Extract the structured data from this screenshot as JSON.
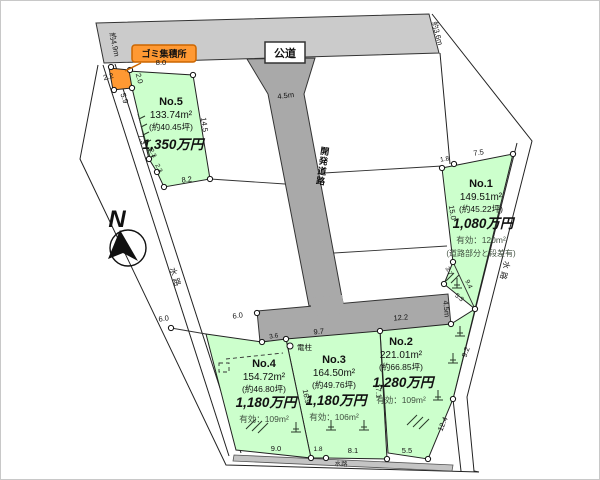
{
  "compass": {
    "north_label": "N"
  },
  "roads": {
    "public_road_label": "公道",
    "public_road_width": "約4.9m",
    "public_road_end_width": "約3.6m",
    "dev_road_label": "開発道路",
    "dev_road_width_top": "4.5m",
    "dev_road_width_bottom": "4.5m"
  },
  "features": {
    "garbage_station": "ゴミ集積所",
    "utility_pole": "電柱",
    "waterway_left": "水路",
    "waterway_right": "水路",
    "waterway_bottom": "水路"
  },
  "plots": [
    {
      "no": "No.1",
      "area": "149.51m²",
      "tsubo": "(約45.22坪)",
      "price": "1,080万円",
      "note1": "有効：120m²",
      "note2": "(道路部分と段差有)"
    },
    {
      "no": "No.2",
      "area": "221.01m²",
      "tsubo": "(約66.85坪)",
      "price": "1,280万円",
      "note1": "有効：109m²"
    },
    {
      "no": "No.3",
      "area": "164.50m²",
      "tsubo": "(約49.76坪)",
      "price": "1,180万円",
      "note1": "有効：106m²"
    },
    {
      "no": "No.4",
      "area": "154.72m²",
      "tsubo": "(約46.80坪)",
      "price": "1,180万円",
      "note1": "有効：109m²"
    },
    {
      "no": "No.5",
      "area": "133.74m²",
      "tsubo": "(約40.45坪)",
      "price": "1,350万円"
    }
  ],
  "dims": {
    "garbage_w": "2.2",
    "garbage_d": "2.0",
    "no5_top": "8.0",
    "no5_left": "5.9",
    "no5_wall": "7.3",
    "no5_right": "14.5",
    "no5_bottom": "8.2",
    "no5_jog1": "2.3",
    "no5_jog2": "2.3",
    "no1_top1": "1.8",
    "no1_top2": "7.5",
    "no1_left": "15.0",
    "no1_b1": "3.7",
    "no1_diag": "9.4",
    "no1_b2": "5.3",
    "front_no4_a": "6.0",
    "front_no4_b": "6.0",
    "front_no3_a": "3.6",
    "front_no3_b": "9.7",
    "front_no2": "12.2",
    "div_34": "16.9",
    "div_23": "17.1",
    "no4_bottom": "9.0",
    "no3_bottom1": "1.8",
    "no3_bottom2": "8.1",
    "no2_bottom": "5.5",
    "no2_right1": "9.2",
    "no2_right2": "12.4"
  },
  "colors": {
    "plot_green": "#ccffcc",
    "road_light": "#cbcbcb",
    "road_dark": "#a9a9a9",
    "accent_orange": "#ff9933",
    "line": "#222222"
  }
}
